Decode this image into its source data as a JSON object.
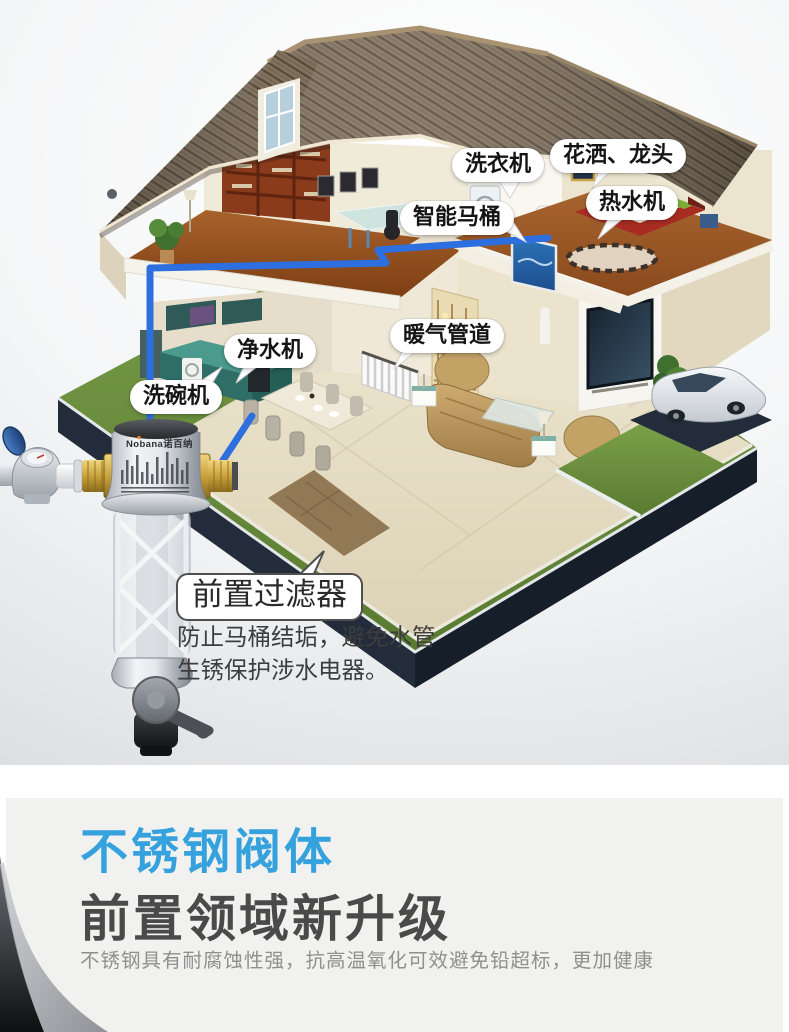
{
  "top_scene": {
    "callouts": {
      "washing_machine": "洗衣机",
      "shower_faucet": "花洒、龙头",
      "smart_toilet": "智能马桶",
      "water_heater": "热水机",
      "water_purifier": "净水机",
      "heating_pipe": "暖气管道",
      "dishwasher": "洗碗机"
    },
    "product": {
      "brand": "Nobana诺百纳",
      "callout": "前置过滤器",
      "description": "防止马桶结垢，避免水管生锈保护涉水电器。"
    }
  },
  "bottom_section": {
    "heading_accent": "不锈钢阀体",
    "heading_main": "前置领域新升级",
    "body": "不锈钢具有耐腐蚀性强，抗高温氧化可效避免铅超标，更加健康"
  },
  "colors": {
    "accent_blue": "#35a1dd",
    "pipe_blue": "#2e6fe0",
    "heading_gray": "#4a4a4a",
    "body_gray": "#8f8f8f",
    "lawn_green": "#6f9440",
    "roof_brown": "#7d6c58"
  }
}
